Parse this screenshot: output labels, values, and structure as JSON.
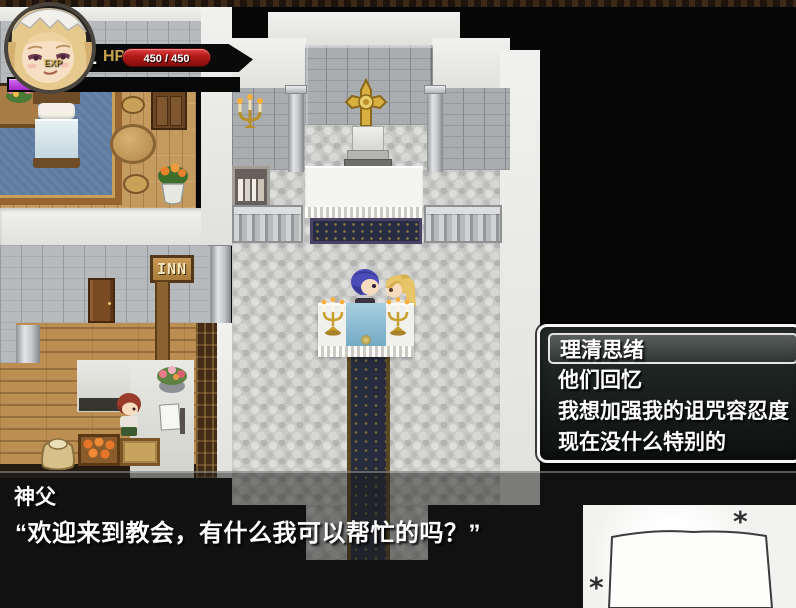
{
  "hud": {
    "lv_label": "LV",
    "level": "1",
    "hp_label": "HP",
    "hp_value": "450 / 450",
    "exp_label": "EXP",
    "hp_color": "#c22020",
    "exp_color": "#bb48e2",
    "gold_color": "#c9a64b"
  },
  "map": {
    "inn_sign": "INN"
  },
  "choice_menu": {
    "items": [
      {
        "label": "理清思绪",
        "selected": true
      },
      {
        "label": "他们回忆",
        "selected": false
      },
      {
        "label": "我想加强我的诅咒容忍度",
        "selected": false
      },
      {
        "label": "现在没什么特别的",
        "selected": false
      }
    ]
  },
  "dialog": {
    "speaker": "神父",
    "text": "“欢迎来到教会，有什么我可以帮忙的吗？”"
  },
  "sketch": {
    "asterisk": "*"
  }
}
